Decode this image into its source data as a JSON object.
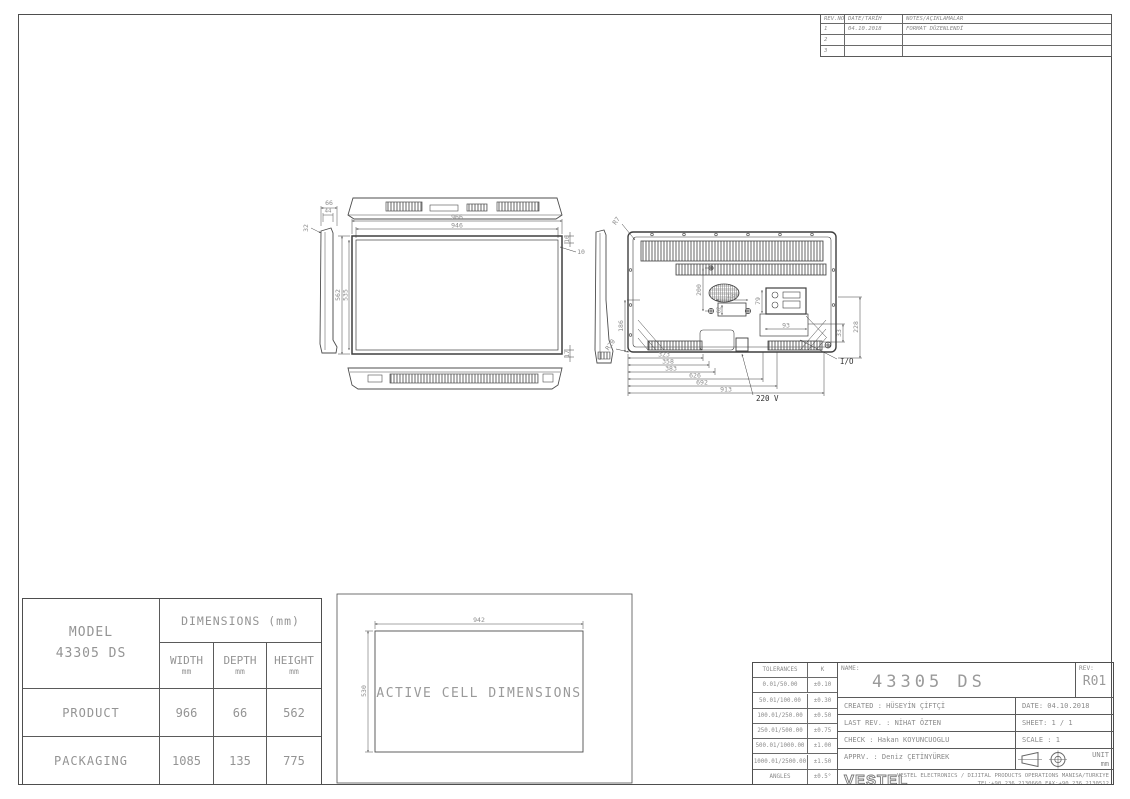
{
  "revision_table": {
    "headers": [
      "REV.NO",
      "DATE/TARİH",
      "NOTES/AÇIKLAMALAR"
    ],
    "rows": [
      {
        "no": "1",
        "date": "04.10.2018",
        "note": "FORMAT DÜZENLENDİ"
      },
      {
        "no": "2",
        "date": "",
        "note": ""
      },
      {
        "no": "3",
        "date": "",
        "note": ""
      }
    ]
  },
  "front_view": {
    "w_outer": "966",
    "w_inner": "946",
    "h_outer": "562",
    "h_inner": "535",
    "bezel_top": "10",
    "bezel_side": "10",
    "bezel_bottom": "17"
  },
  "side_view": {
    "depth": "66",
    "depth_inner": "44",
    "depth_top": "32"
  },
  "rear_view": {
    "r_top": "R7",
    "r_bottom": "R20",
    "vesa_v": "200",
    "vesa_h": "130",
    "vesa_inner": "62",
    "io_h": "79",
    "io_w": "93",
    "left_h": "186",
    "right_h": "228",
    "right_offset": "33",
    "chain": [
      "323",
      "358",
      "383",
      "626",
      "692",
      "913"
    ],
    "power_label": "220 V",
    "io_label": "I/O"
  },
  "active_cell": {
    "label": "ACTIVE CELL DIMENSIONS",
    "width": "942",
    "height": "530"
  },
  "dim_table": {
    "model_label": "MODEL",
    "model_value": "43305 DS",
    "dims_header": "DIMENSIONS (mm)",
    "cols": [
      {
        "t": "WIDTH",
        "u": "mm"
      },
      {
        "t": "DEPTH",
        "u": "mm"
      },
      {
        "t": "HEIGHT",
        "u": "mm"
      }
    ],
    "rows": [
      {
        "label": "PRODUCT",
        "width": "966",
        "depth": "66",
        "height": "562"
      },
      {
        "label": "PACKAGING",
        "width": "1085",
        "depth": "135",
        "height": "775"
      }
    ]
  },
  "title_block": {
    "tolerances": {
      "header_left": "TOLERANCES",
      "header_right": "K",
      "rows": [
        {
          "range": "0.01/50.00",
          "tol": "±0.10"
        },
        {
          "range": "50.01/100.00",
          "tol": "±0.30"
        },
        {
          "range": "100.01/250.00",
          "tol": "±0.50"
        },
        {
          "range": "250.01/500.00",
          "tol": "±0.75"
        },
        {
          "range": "500.01/1000.00",
          "tol": "±1.00"
        },
        {
          "range": "1000.01/2500.00",
          "tol": "±1.50"
        },
        {
          "range": "ANGLES",
          "tol": "±0.5°"
        }
      ]
    },
    "name_label": "NAME:",
    "name_value": "43305 DS",
    "rev_label": "REV:",
    "rev_value": "R01",
    "created": "CREATED : HÜSEYİN ÇİFTÇİ",
    "date": "DATE: 04.10.2018",
    "last_rev": "LAST REV. : NİHAT ÖZTEN",
    "sheet": "SHEET: 1 / 1",
    "check": "CHECK : Hakan KOYUNCUOGLU",
    "scale": "SCALE : 1",
    "apprv": "APPRV. : Deniz ÇETİNYÜREK",
    "unit_label": "UNIT",
    "unit_value": "mm",
    "brand": "VESTEL",
    "company_line1": "VESTEL ELECTRONICS / DIJITAL PRODUCTS OPERATIONS MANISA/TURKIYE",
    "company_line2": "TEL:+90.236.2130660 FAX:+90.236.2130512"
  }
}
